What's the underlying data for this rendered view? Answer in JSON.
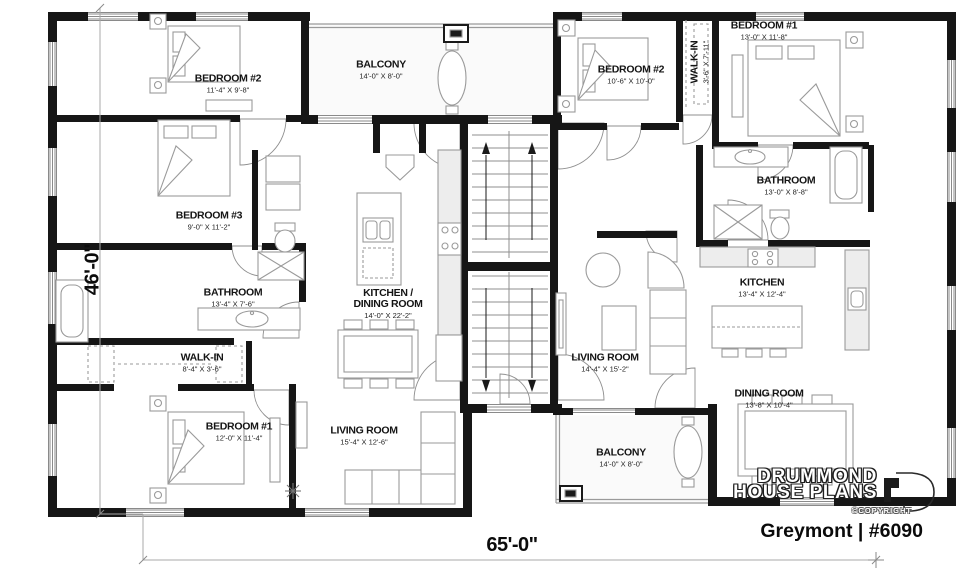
{
  "plan": {
    "title": "Greymont | #6090",
    "brand_line1": "DRUMMOND",
    "brand_line2": "HOUSE PLANS",
    "copyright": "©COPYRIGHT",
    "width_dim": "65'-0\"",
    "height_dim": "46'-0\"",
    "wall_color": "#161616",
    "accent_gray": "#9a9a9a"
  },
  "rooms": [
    {
      "name": "BEDROOM #2",
      "dims": "11'-4\" X 9'-8\""
    },
    {
      "name": "BALCONY",
      "dims": "14'-0\" X 8'-0\""
    },
    {
      "name": "BEDROOM #2",
      "dims": "10'-6\" X 10'-0\""
    },
    {
      "name": "WALK-IN",
      "dims": "3'-6\" X 7'-11\""
    },
    {
      "name": "BEDROOM #1",
      "dims": "13'-0\" X 11'-8\""
    },
    {
      "name": "BEDROOM #3",
      "dims": "9'-0\" X 11'-2\""
    },
    {
      "name": "BATHROOM",
      "dims": "13'-0\" X 8'-8\""
    },
    {
      "name": "BATHROOM",
      "dims": "13'-4\" X 7'-6\""
    },
    {
      "name": "KITCHEN /\nDINING ROOM",
      "dims": "14'-0\" X 22'-2\""
    },
    {
      "name": "KITCHEN",
      "dims": "13'-4\" X 12'-4\""
    },
    {
      "name": "WALK-IN",
      "dims": "8'-4\" X 3'-6\""
    },
    {
      "name": "LIVING ROOM",
      "dims": "14'-4\" X 15'-2\""
    },
    {
      "name": "BEDROOM #1",
      "dims": "12'-0\" X 11'-4\""
    },
    {
      "name": "LIVING ROOM",
      "dims": "15'-4\" X 12'-6\""
    },
    {
      "name": "DINING ROOM",
      "dims": "13'-8\" X 10'-4\""
    },
    {
      "name": "BALCONY",
      "dims": "14'-0\" X 8'-0\""
    }
  ]
}
